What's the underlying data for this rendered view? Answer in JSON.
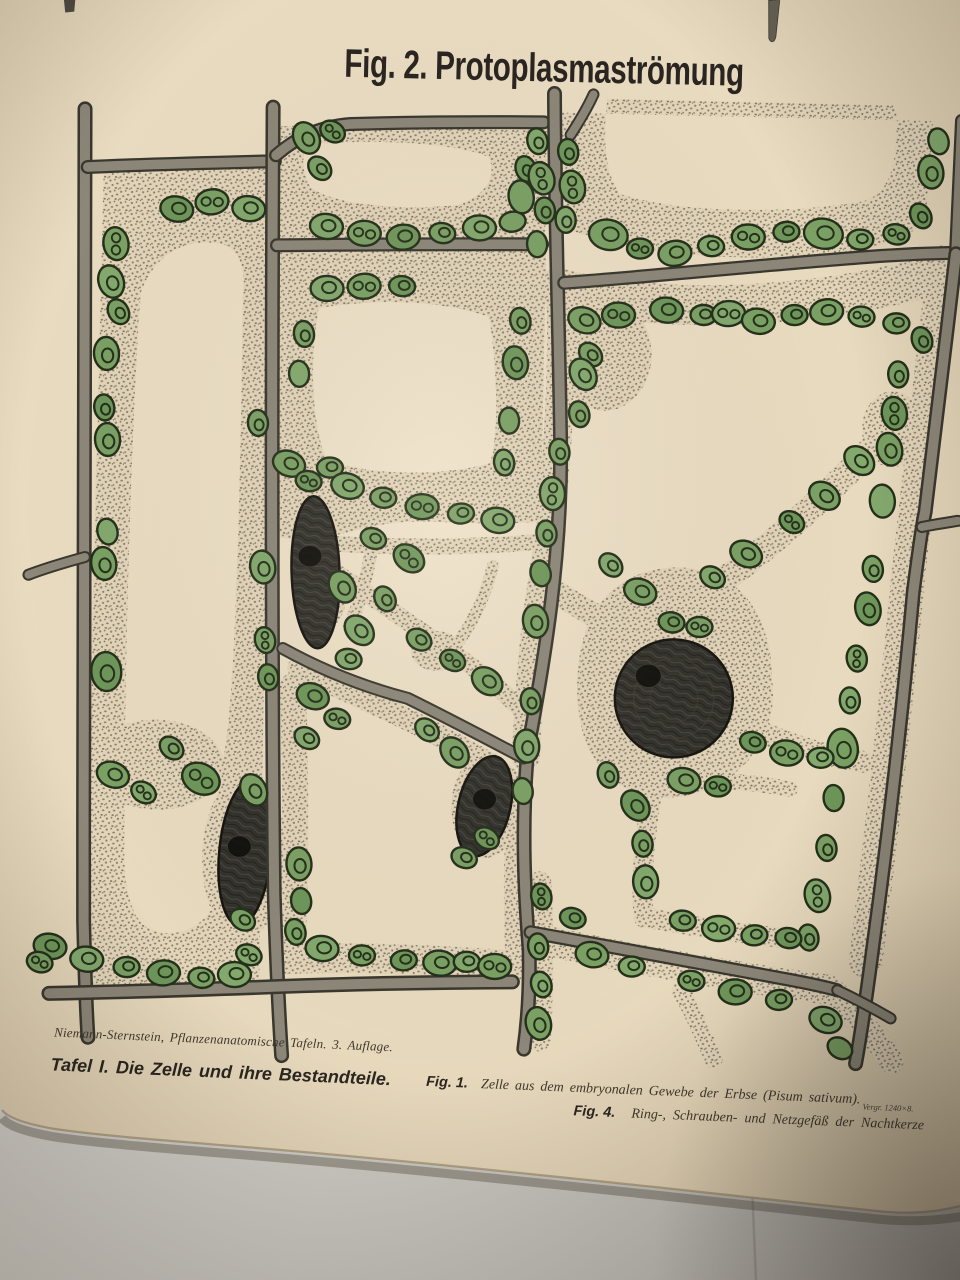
{
  "photo": {
    "title": "Fig. 2. Protoplasmaströmung",
    "captions": {
      "attribution": "Niemann-Sternstein, Pflanzenanatomische Tafeln.  3. Auflage.",
      "plate": "Tafel I.  Die Zelle und ihre Bestandteile.",
      "fig1_label": "Fig. 1.",
      "fig1_text": "Zelle aus dem embryonalen Gewebe der Erbse (Pisum sativum).",
      "fig1_magnification": "Vergr. 1240×8.",
      "fig4_label": "Fig. 4.",
      "fig4_text": "Ring-, Schrauben- und Netzgefäß der Nachtkerze"
    },
    "palette": {
      "paper": "#e9dbc1",
      "paper_edge": "#9a8767",
      "backdrop": "#d3d0c8",
      "wall": "#8d8779",
      "wall_outline": "#3a382e",
      "stipple_bg": "#e4d5b9",
      "stipple_dot": "#8a8373",
      "stipple_dot2": "#79735f",
      "chloroplast": "#7ba164",
      "chloroplast_alt": "#83a96d",
      "chloroplast_dark": "#6f975a",
      "chloroplast_outline": "#25301b",
      "nucleus": "#33322c",
      "nucleus_outline": "#16150f",
      "ink": "#2a2521",
      "ink_serif": "#3f382c"
    }
  }
}
